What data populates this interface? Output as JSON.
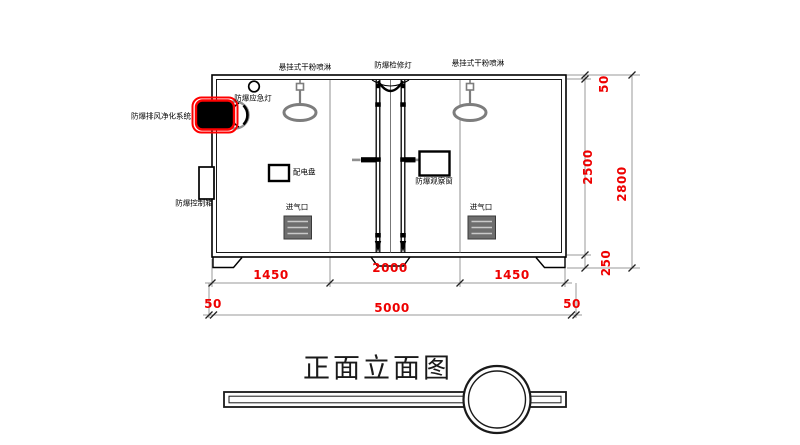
{
  "title": {
    "text": "正面立面图"
  },
  "labels": {
    "sprinkler_left": "悬挂式干粉喷淋",
    "inspection_lamp": "防爆检修灯",
    "sprinkler_right": "悬挂式干粉喷淋",
    "emergency_lamp": "防爆应急灯",
    "exhaust_purifier": "防爆排风净化系统",
    "control_box": "防爆控制箱",
    "power_panel": "配电盘",
    "observation_window": "防爆观察窗",
    "air_inlet_left": "进气口",
    "air_inlet_right": "进气口"
  },
  "dimensions": {
    "seg_left": "1450",
    "seg_mid": "2000",
    "seg_right": "1450",
    "margin_left": "50",
    "overall_width": "5000",
    "margin_right": "50",
    "top_offset": "50",
    "inner_height": "2500",
    "overall_height": "2800",
    "base_height": "250"
  },
  "colors": {
    "dimension_red": "#ee0000",
    "highlight_red": "#ff0000",
    "line_black": "#000000",
    "line_gray": "#9a9a9a",
    "sprinkler_gray": "#7d7d7d",
    "louver_gray": "#6e6e6e"
  }
}
